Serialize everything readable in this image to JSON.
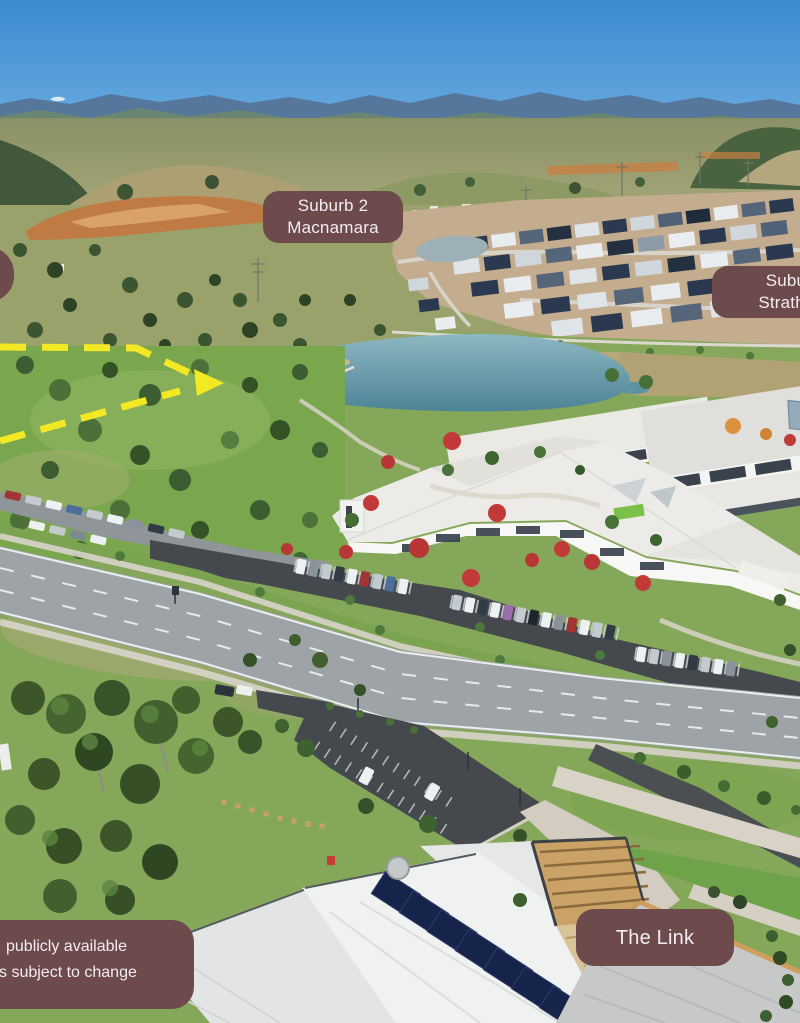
{
  "labels": {
    "suburb2": {
      "line1": "Suburb 2",
      "line2": "Macnamara"
    },
    "suburb1": {
      "line1": "Suburb 1",
      "line2": "Strathnairn",
      "clipped_at_right_edge": true
    },
    "the_link": {
      "line1": "The Link"
    },
    "left_box": {
      "line1": "",
      "clipped_at_left_edge": true
    }
  },
  "disclaimer": {
    "line1": "publicly available",
    "line2": "s subject to change",
    "clipped_at_left_edge": true
  },
  "colors": {
    "label_background": "#6d4a4c",
    "label_text": "#f4eeee",
    "boundary_dash_yellow": "#f2e823",
    "sky_top": "#3c8bd0",
    "lake_teal": "#5e93a3",
    "red_tree": "#c13a38",
    "solar_panel_navy": "#16234a"
  },
  "boundary": {
    "style": "dashed",
    "has_arrowhead": true
  },
  "scene": {
    "kind": "aerial render of suburban development",
    "features": [
      "sky",
      "mountain-ranges",
      "earthworks",
      "housing-estate",
      "retention-pond",
      "lake",
      "parkland-trees",
      "white-roof-community-buildings",
      "red-autumn-trees",
      "car-parks-with-cars",
      "main-road",
      "eucalyptus-woodland",
      "small-car-park",
      "solar-roof-building",
      "timber-pergola",
      "yellow-dashed-boundary"
    ]
  }
}
